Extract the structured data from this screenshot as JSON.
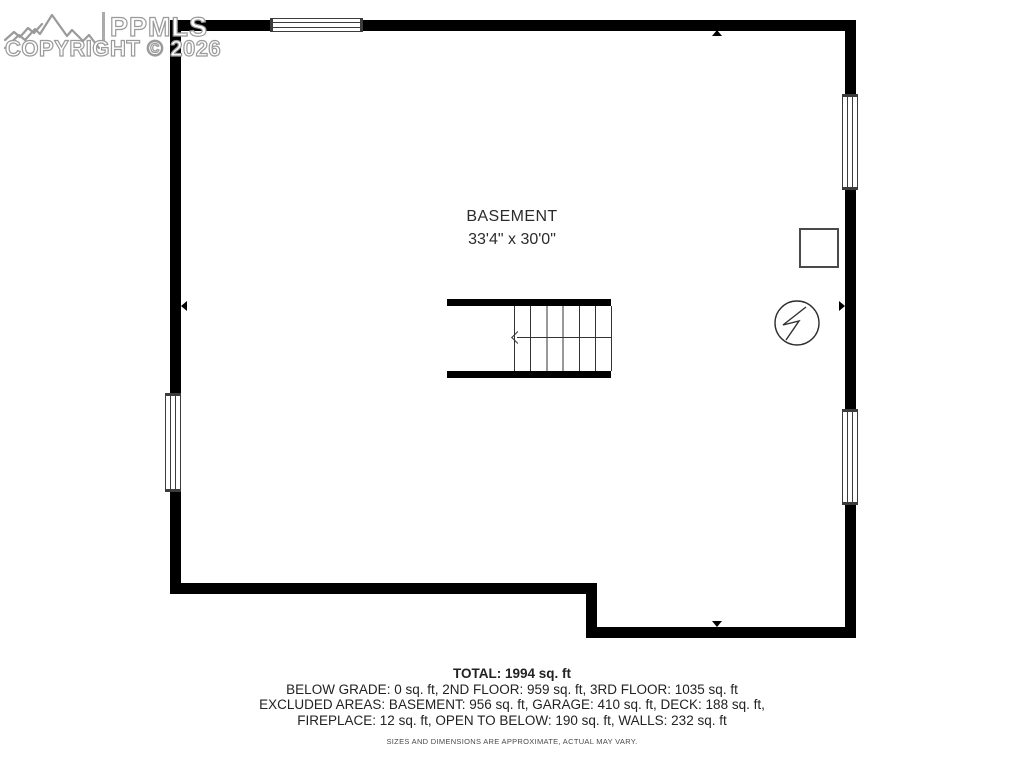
{
  "watermark": {
    "brand": "PPMLS",
    "copyright": "COPYRIGHT © 2026",
    "logo_icon": "mountain-range-icon"
  },
  "floor_plan": {
    "room_label": "BASEMENT",
    "room_dimensions": "33'4\" x 30'0\"",
    "symbols": {
      "stairs_direction_icon": "left-arrow",
      "utility_circle_icon": "circle-with-lightning-bolt",
      "furnace_square_icon": "square-outline",
      "wall_markers": "small-black-triangles"
    }
  },
  "summary": {
    "total": "TOTAL: 1994 sq. ft",
    "floors_line": "BELOW GRADE: 0 sq. ft, 2ND FLOOR: 959 sq. ft, 3RD FLOOR: 1035 sq. ft",
    "excluded_line1": "EXCLUDED AREAS: BASEMENT: 956 sq. ft, GARAGE: 410 sq. ft, DECK: 188 sq. ft,",
    "excluded_line2": "FIREPLACE: 12 sq. ft, OPEN TO BELOW: 190 sq. ft, WALLS: 232 sq. ft",
    "disclaimer": "SIZES AND DIMENSIONS ARE APPROXIMATE, ACTUAL MAY VARY."
  },
  "colors": {
    "wall": "#000000",
    "text": "#2b2b2b",
    "watermark_outline": "#9a9a9a",
    "background": "#ffffff"
  }
}
